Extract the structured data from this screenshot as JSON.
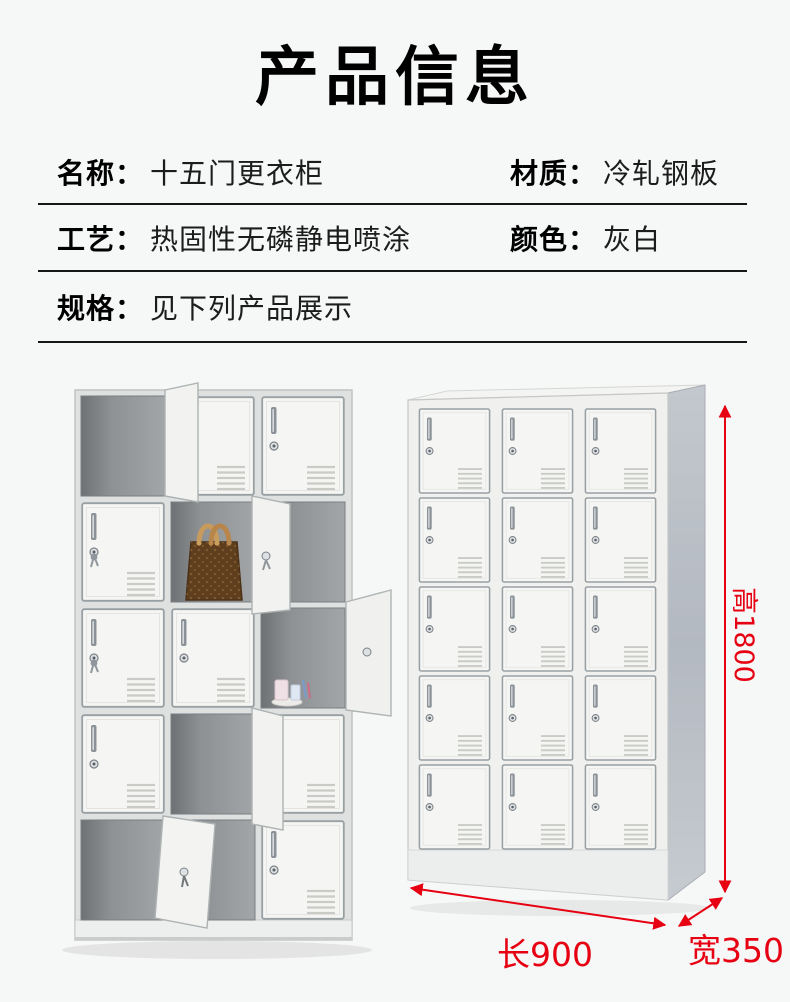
{
  "title": "产品信息",
  "specs": {
    "rows": [
      {
        "cells": [
          {
            "label": "名称：",
            "value": "十五门更衣柜"
          },
          {
            "label": "材质：",
            "value": "冷轧钢板"
          }
        ]
      },
      {
        "cells": [
          {
            "label": "工艺：",
            "value": "热固性无磷静电喷涂"
          },
          {
            "label": "颜色：",
            "value": "灰白"
          }
        ]
      },
      {
        "cells": [
          {
            "label": "规格：",
            "value": "见下列产品展示"
          }
        ]
      }
    ]
  },
  "dimensions": {
    "height_label": "高1800",
    "length_label": "长900",
    "width_label": "宽350",
    "accent_color": "#e60012"
  }
}
